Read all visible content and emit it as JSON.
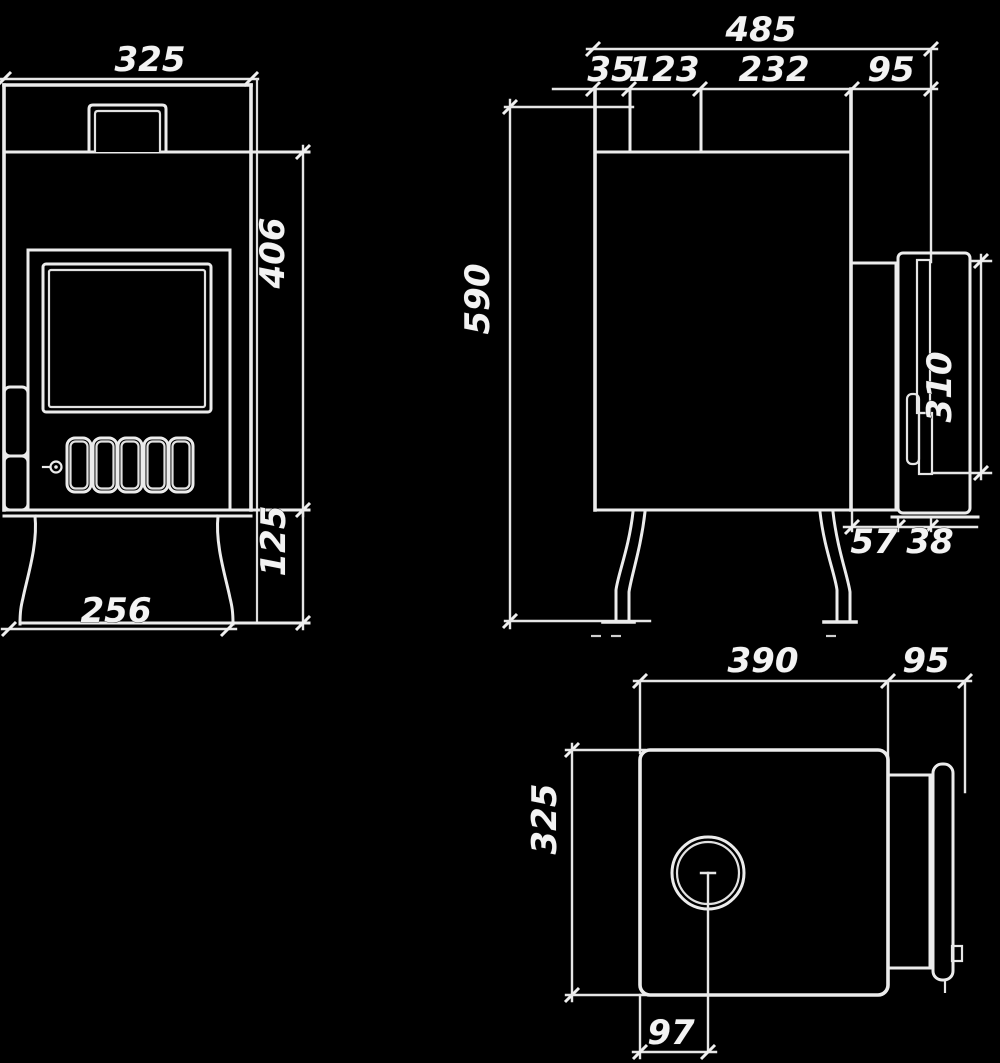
{
  "drawing": {
    "type": "three-view technical drawing of a wood stove",
    "colors": {
      "background": "#000000",
      "line": "#ececec",
      "label": "#f3f3f3"
    }
  },
  "front_view": {
    "labels": {
      "overall_width": "325",
      "body_height": "406",
      "base_height": "125",
      "base_width": "256"
    }
  },
  "side_view": {
    "labels": {
      "overall_depth": "485",
      "segment_rear": "35",
      "segment_flue": "123",
      "segment_mid": "232",
      "segment_door": "95",
      "overall_height": "590",
      "handle_length": "310",
      "gap_bottom": "57",
      "door_bottom": "38"
    }
  },
  "top_view": {
    "labels": {
      "body_depth": "390",
      "door_panel_depth": "95",
      "body_width": "325",
      "flue_center_offset": "97"
    }
  }
}
